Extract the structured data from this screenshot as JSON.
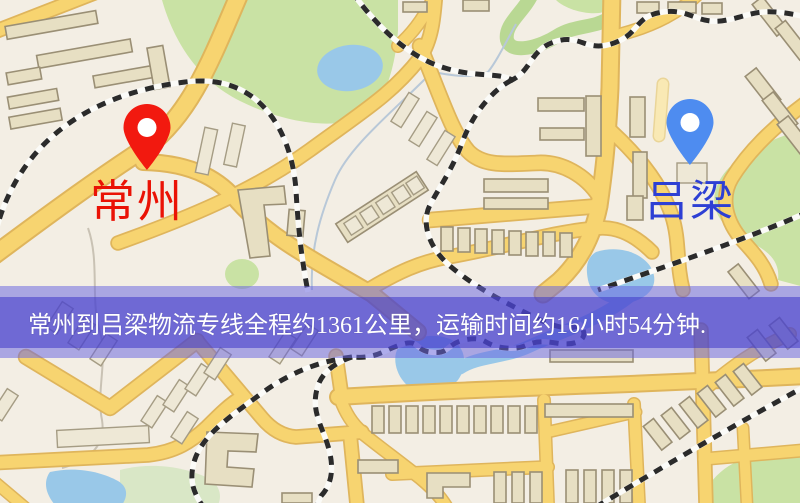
{
  "banner": {
    "text": "常州到吕梁物流专线全程约1361公里，运输时间约16小时54分钟.",
    "text_color": "#ffffff",
    "bg_color_outer": "#6864e0",
    "bg_color_inner": "#4a43c8"
  },
  "route": {
    "origin": "常州",
    "destination": "吕梁",
    "distance_text": "约1361公里",
    "duration_text": "约16小时54分钟"
  },
  "markers": {
    "origin": {
      "label": "常州",
      "pin_color": "#f2190f",
      "label_color": "#ea1205"
    },
    "destination": {
      "label": "吕梁",
      "pin_color": "#4e8cf0",
      "label_color": "#2d3fd4"
    }
  },
  "map_colors": {
    "background": "#f3eee4",
    "road_fill": "#f7d470",
    "road_casing": "#dfb55c",
    "building": "#e7dfc3",
    "park_green": "#c9e2a4",
    "water_blue": "#99c8e8",
    "railway": "#2b2b2b"
  }
}
